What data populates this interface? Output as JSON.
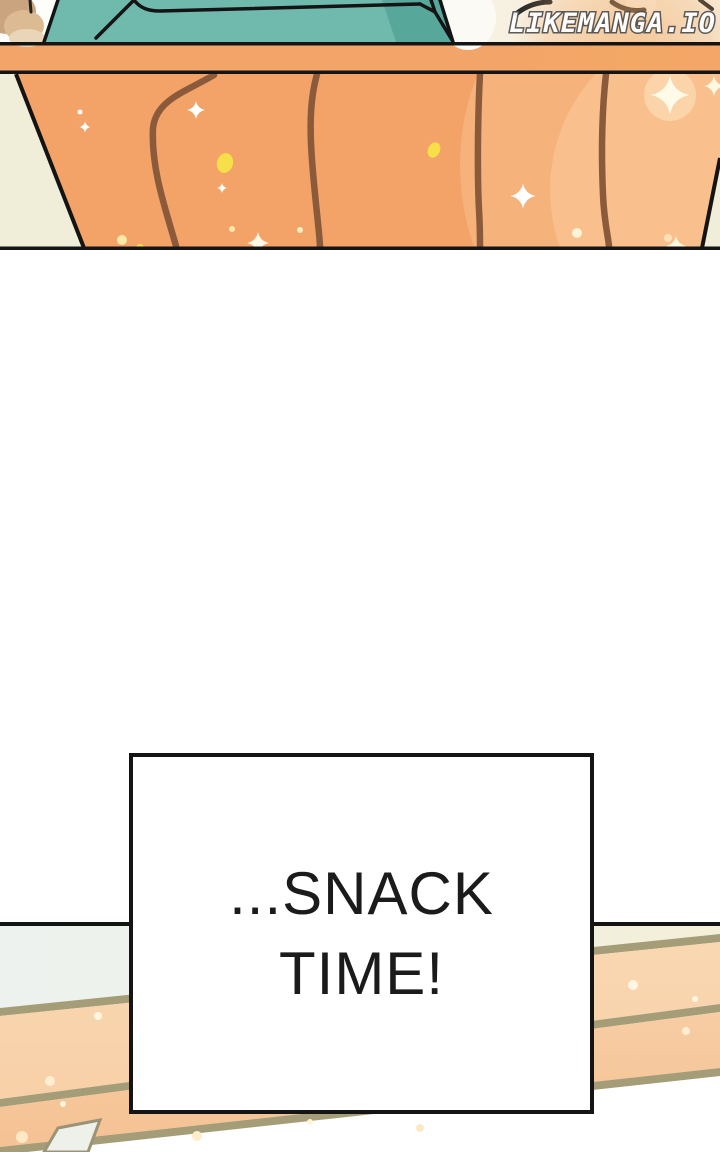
{
  "watermark": {
    "text": "LIKEMANGA.IO"
  },
  "caption": {
    "line1": "...SNACK",
    "line2": "TIME!"
  },
  "colors": {
    "page_bg": "#ffffff",
    "ink": "#141414",
    "teal": "#6fb9ad",
    "teal_shadow": "#58a79b",
    "orange_band": "#f3a469",
    "orange_panel": "#f3a268",
    "wood_grain": "#8a5a3a",
    "cream": "#f0edd9",
    "top_cream": "#f6efdf",
    "hand_tan": "#c9a47e",
    "hand_tan_light": "#dcba92",
    "plank_peach": "#f8d0a8",
    "plank_peach_dark": "#f4c193",
    "stripe_tan": "#a59d78",
    "panel_blue_white": "#edf2ef",
    "panel_cream": "#f3efd8",
    "caption_text": "#1b1b1b",
    "watermark_fill": "#ffffff",
    "watermark_outline": "#4e4e4e"
  }
}
